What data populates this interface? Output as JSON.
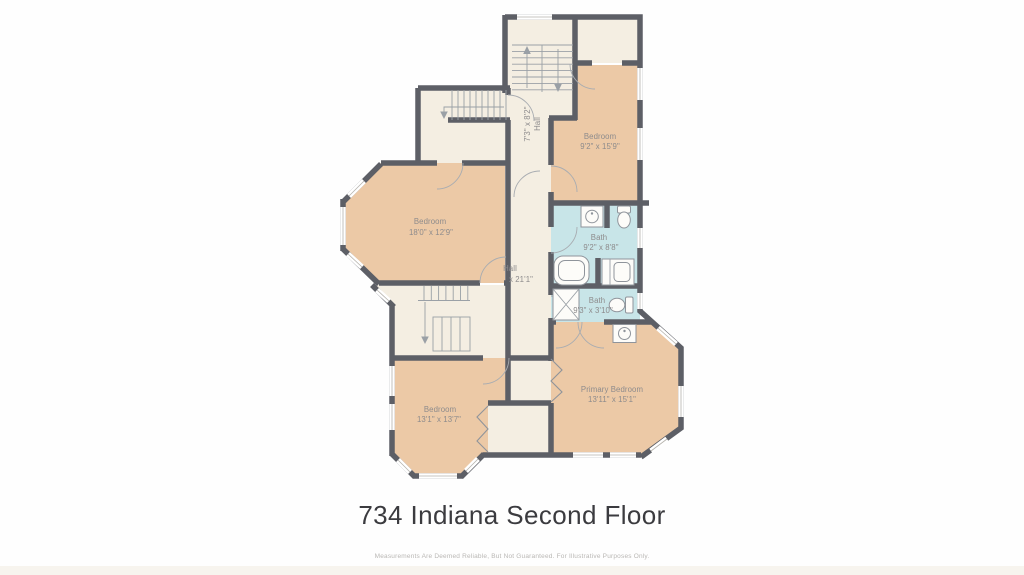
{
  "page": {
    "title": "734 Indiana Second Floor",
    "disclaimer": "Measurements Are Deemed Reliable, But Not Guaranteed. For Illustrative Purposes Only."
  },
  "colors": {
    "wall": "#5d5f66",
    "floor": "#f4eee2",
    "bedroom-fill": "#ecc9a6",
    "bath-fill": "#c8e5e8",
    "window": "#ffffff",
    "line": "#9aa0a6",
    "label": "#8d8b8c",
    "title": "#3b3b3f",
    "disclaimer": "#b9b7b4"
  },
  "rooms": {
    "hall_upper": {
      "name": "Hall",
      "dims": "7'3\" x 8'2\""
    },
    "bedroom_top": {
      "name": "Bedroom",
      "dims": "9'2\" x 15'9\""
    },
    "bedroom_left": {
      "name": "Bedroom",
      "dims": "18'0\" x 12'9\""
    },
    "hall_main": {
      "name": "Hall",
      "dims": "x 21'1\""
    },
    "bath_main": {
      "name": "Bath",
      "dims": "9'2\" x 8'8\""
    },
    "bath_small": {
      "name": "Bath",
      "dims": "9'3\" x 3'10\""
    },
    "bedroom_bottom": {
      "name": "Bedroom",
      "dims": "13'1\" x 13'7\""
    },
    "primary_bedroom": {
      "name": "Primary Bedroom",
      "dims": "13'11\" x 15'1\""
    }
  }
}
